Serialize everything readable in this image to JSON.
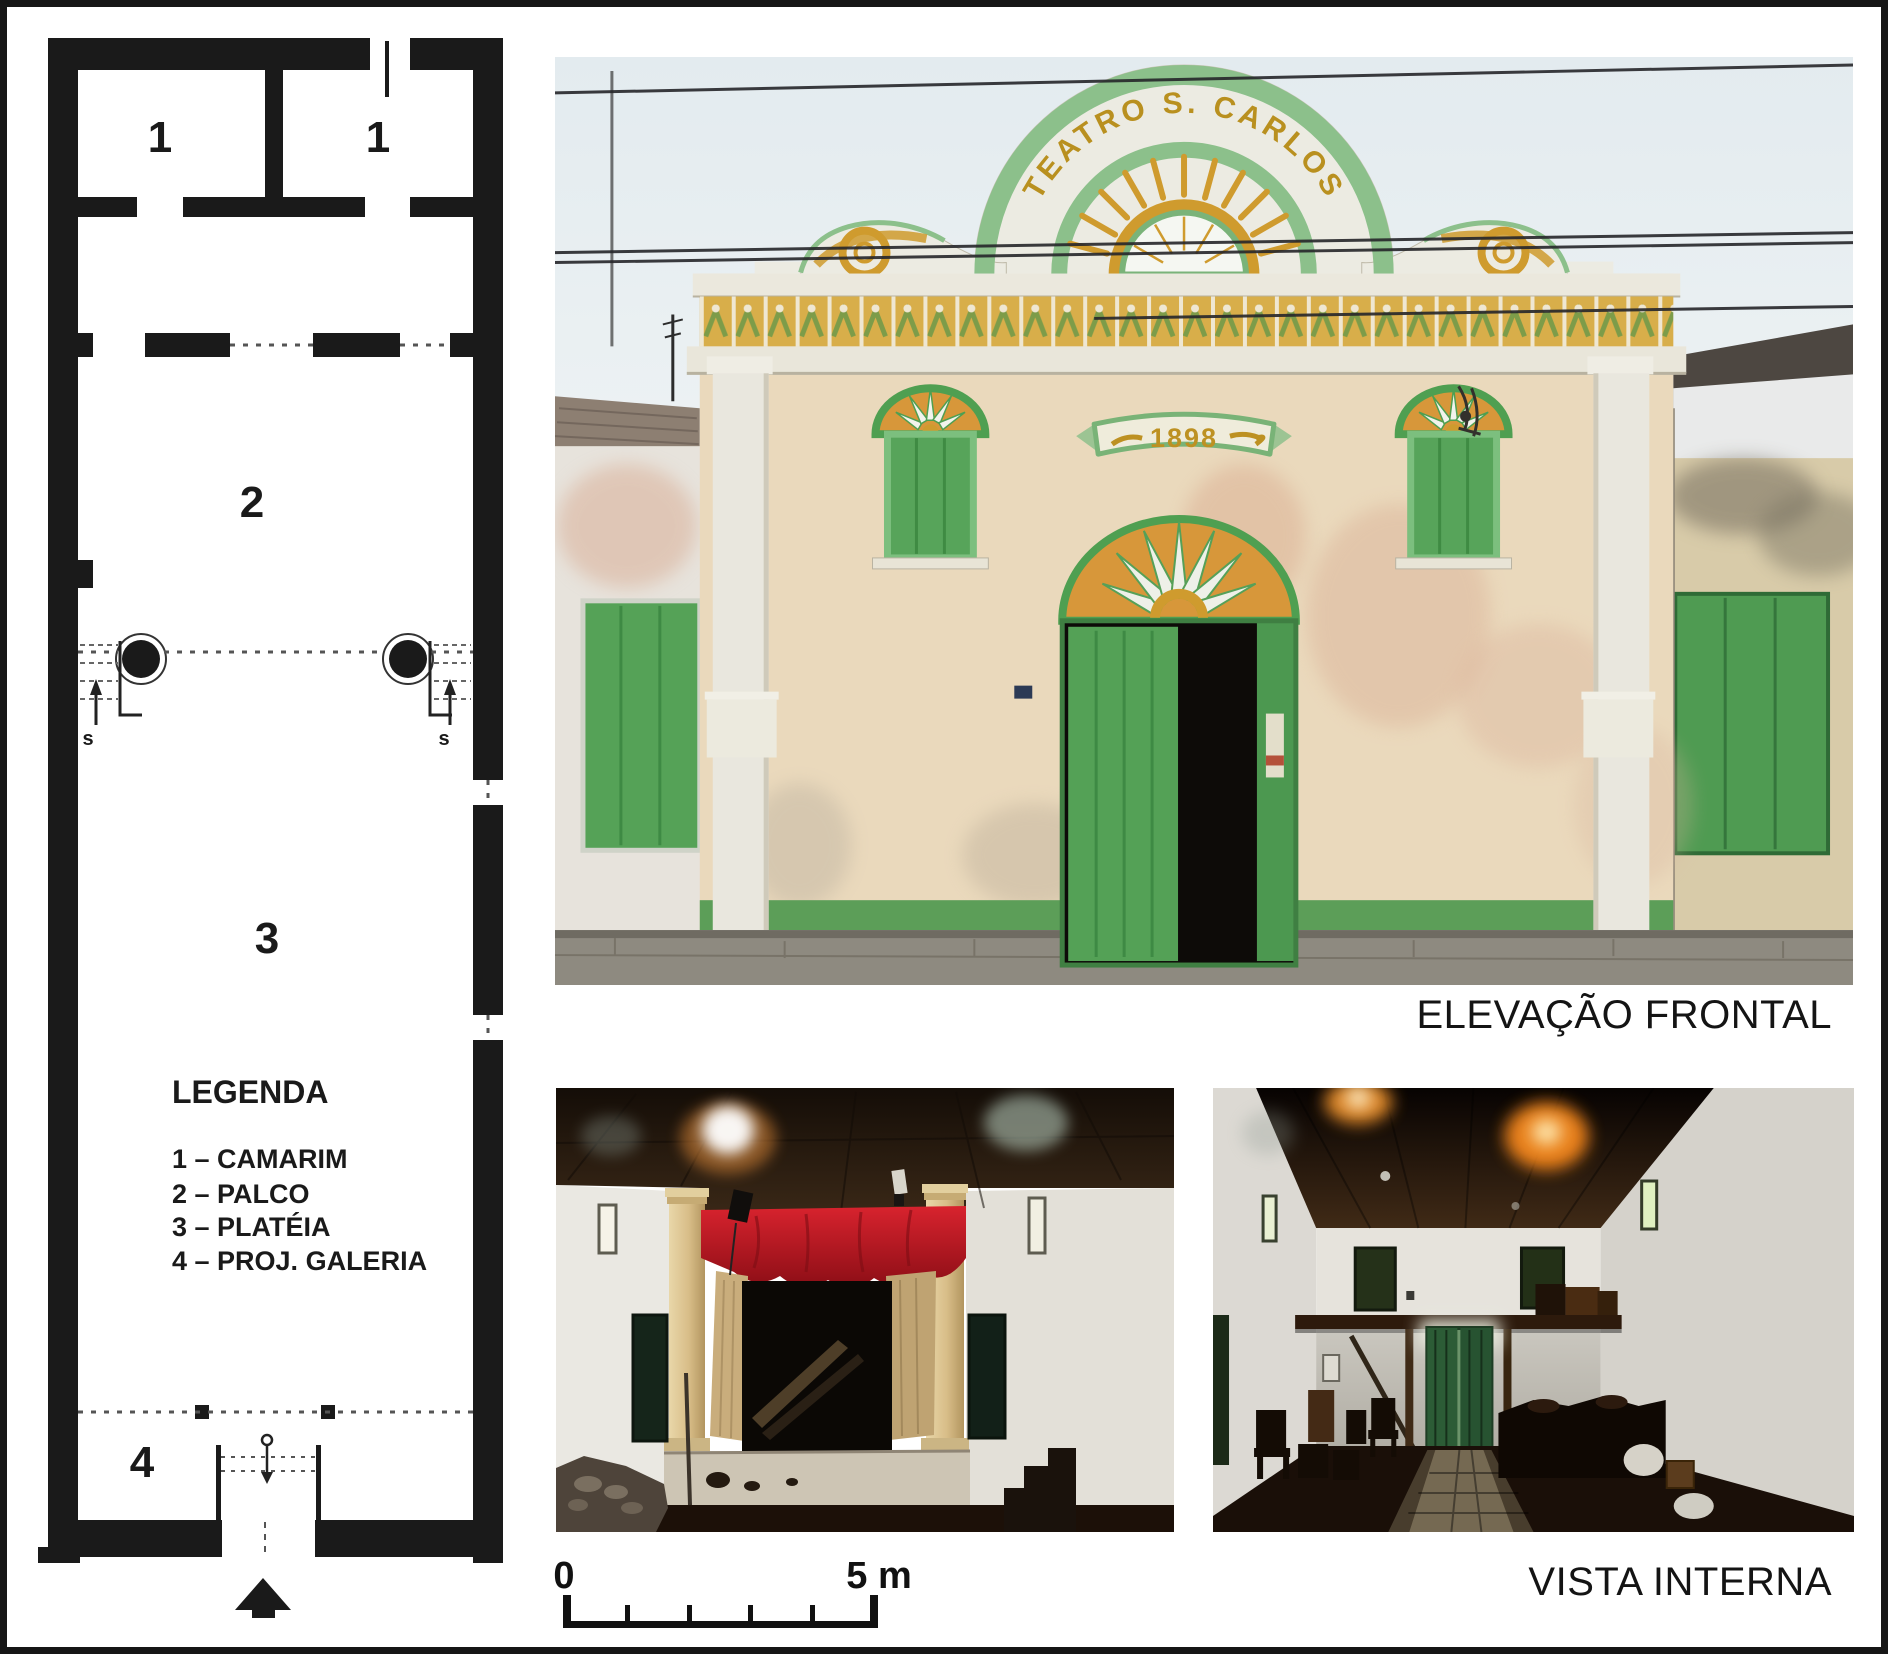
{
  "plan": {
    "labels": {
      "room1_left": "1",
      "room1_right": "1",
      "room2": "2",
      "room3": "3",
      "room4": "4",
      "stair_left": "s",
      "stair_right": "s"
    },
    "legend": {
      "title": "LEGENDA",
      "items": [
        {
          "label": "1 – CAMARIM"
        },
        {
          "label": "2 – PALCO"
        },
        {
          "label": "3 – PLATÉIA"
        },
        {
          "label": "4 – PROJ. GALERIA"
        }
      ]
    }
  },
  "facade": {
    "caption": "ELEVAÇÃO FRONTAL",
    "arch_text": "TEATRO S. CARLOS",
    "banner_year": "1898"
  },
  "interior": {
    "caption": "VISTA INTERNA"
  },
  "scale": {
    "zero": "0",
    "five_m": "5 m"
  },
  "colors": {
    "plan_ink": "#1a1a1a",
    "door_green": "#55a257",
    "arch_band_green": "#8cc08b",
    "ornament_gold": "#cf9b2e",
    "wall_cream": "#ead9bc",
    "curtain_red": "#c01622",
    "curtain_tan": "#c9ad7c",
    "caption_text": "#141414"
  }
}
